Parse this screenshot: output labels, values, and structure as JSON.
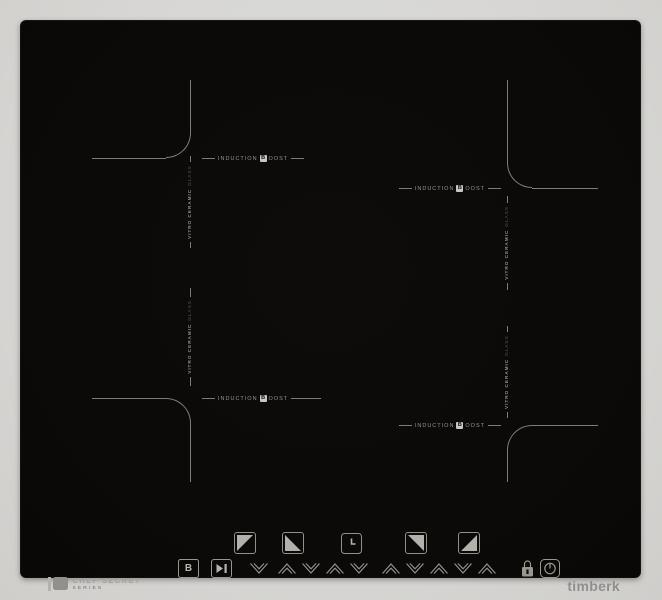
{
  "product": {
    "type": "induction-cooktop",
    "brand_name": "timberk",
    "series": {
      "title": "CHEF SECRET",
      "subtitle": "SERIES"
    }
  },
  "zone_labels": {
    "induction_boost": {
      "pre": "INDUCTION",
      "boxed": "B",
      "post": "OOST"
    },
    "vitro_ceramic": {
      "main": "VITRO CERAMIC",
      "dim": "GLASS"
    }
  },
  "zones": [
    {
      "name": "rear-left"
    },
    {
      "name": "rear-right"
    },
    {
      "name": "front-left"
    },
    {
      "name": "front-right"
    }
  ],
  "controls": {
    "boost_key_label": "B",
    "zone_select_keys": [
      "rear-left",
      "front-left",
      "rear-right",
      "front-right"
    ],
    "icons": [
      "boost-key-icon",
      "play-pause-icon",
      "chevron-down-icon",
      "chevron-up-icon",
      "zone-select-rear-left-icon",
      "zone-select-front-left-icon",
      "timer-clock-icon",
      "zone-select-rear-right-icon",
      "zone-select-front-right-icon",
      "lock-icon",
      "power-icon"
    ]
  },
  "colors": {
    "glass": "#0c0a08",
    "surround": "#d8d7d5",
    "zone_line": "#7b7b77",
    "label_bright": "#93938d",
    "label_dim": "#56544f",
    "icon": "#97978f",
    "boxed_b_background": "#c7c7c3"
  }
}
